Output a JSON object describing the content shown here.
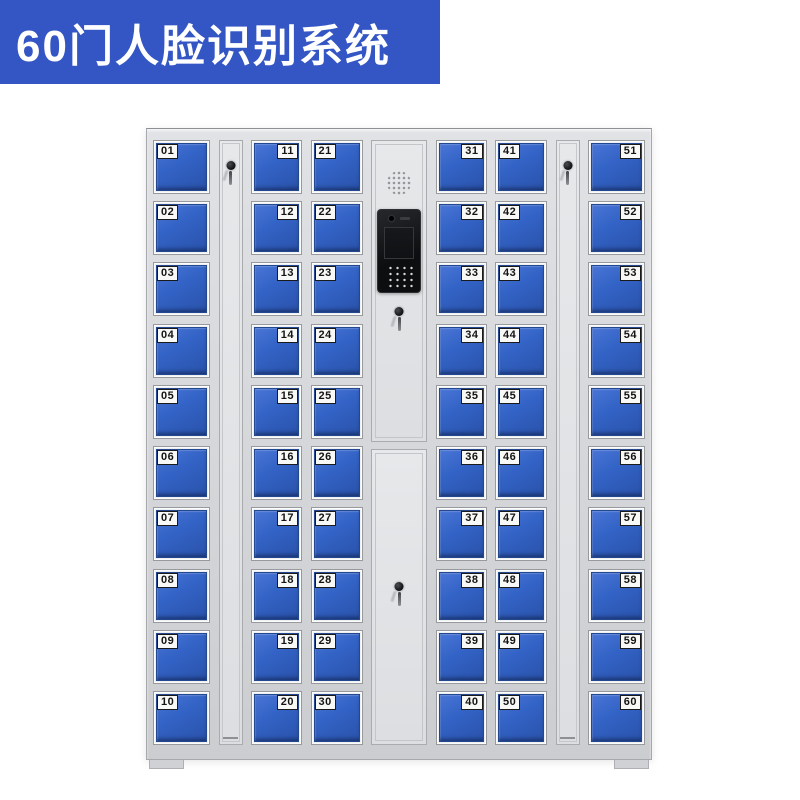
{
  "banner": {
    "text": "60门人脸识别系统"
  },
  "colors": {
    "banner_bg": "#3456c5",
    "banner_text": "#ffffff",
    "door_blue": "#3363c6",
    "cabinet_gray": "#d6d8db",
    "label_bg": "#f8f8f6",
    "label_text": "#141414",
    "screen_black": "#0d0e10"
  },
  "locker": {
    "sections": [
      {
        "type": "doors",
        "name": "column-01-10",
        "label_side": "left",
        "doors": [
          "01",
          "02",
          "03",
          "04",
          "05",
          "06",
          "07",
          "08",
          "09",
          "10"
        ]
      },
      {
        "type": "keystrip",
        "name": "key-strip-left"
      },
      {
        "type": "doors",
        "name": "column-11-20",
        "label_side": "right",
        "doors": [
          "11",
          "12",
          "13",
          "14",
          "15",
          "16",
          "17",
          "18",
          "19",
          "20"
        ]
      },
      {
        "type": "doors",
        "name": "column-21-30",
        "label_side": "left",
        "doors": [
          "21",
          "22",
          "23",
          "24",
          "25",
          "26",
          "27",
          "28",
          "29",
          "30"
        ]
      },
      {
        "type": "control",
        "name": "control-column"
      },
      {
        "type": "doors",
        "name": "column-31-40",
        "label_side": "right",
        "doors": [
          "31",
          "32",
          "33",
          "34",
          "35",
          "36",
          "37",
          "38",
          "39",
          "40"
        ]
      },
      {
        "type": "doors",
        "name": "column-41-50",
        "label_side": "left",
        "doors": [
          "41",
          "42",
          "43",
          "44",
          "45",
          "46",
          "47",
          "48",
          "49",
          "50"
        ]
      },
      {
        "type": "keystrip",
        "name": "key-strip-right"
      },
      {
        "type": "doors",
        "name": "column-51-60",
        "label_side": "right",
        "doors": [
          "51",
          "52",
          "53",
          "54",
          "55",
          "56",
          "57",
          "58",
          "59",
          "60"
        ]
      }
    ]
  }
}
